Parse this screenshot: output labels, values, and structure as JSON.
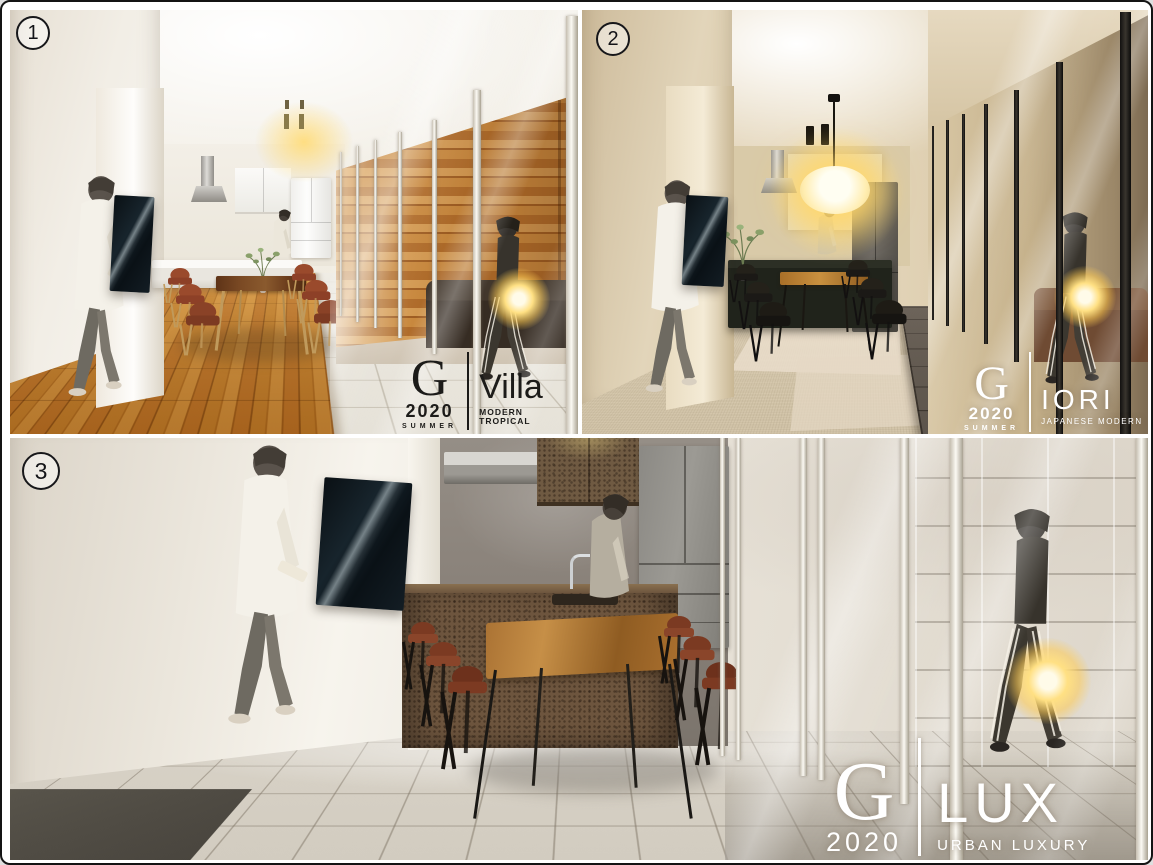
{
  "frame": {
    "background": "#ffffff",
    "border_color": "#141414"
  },
  "panels": [
    {
      "number": "1",
      "logo": {
        "brand": "G",
        "year": "2020",
        "season": "SUMMER",
        "name": "Villa",
        "tagline": "MODERN TROPICAL",
        "color": "#1c1b19"
      },
      "palette": {
        "wall": "#efe9df",
        "wood_floor": "#c17a24",
        "accent_wood_wall": "#b9782f",
        "tile": "#edeae3",
        "glow": "#ffd76a"
      }
    },
    {
      "number": "2",
      "logo": {
        "brand": "G",
        "year": "2020",
        "season": "SUMMER",
        "name": "IORI",
        "tagline": "JAPANESE MODERN",
        "color": "#ffffff"
      },
      "palette": {
        "wall": "#e3d5bb",
        "floor_mat": "#ddd0b7",
        "floor_tile_dark": "#6b6157",
        "glow": "#ffd76a"
      }
    },
    {
      "number": "3",
      "logo": {
        "brand": "G",
        "year": "2020",
        "name": "LUX",
        "tagline": "URBAN LUXURY",
        "color": "#ffffff"
      },
      "palette": {
        "wall": "#e8e3da",
        "floor_tile": "#d9d3c8",
        "counter_rust": "#6d553e",
        "glow": "#ffd76a"
      }
    }
  ]
}
